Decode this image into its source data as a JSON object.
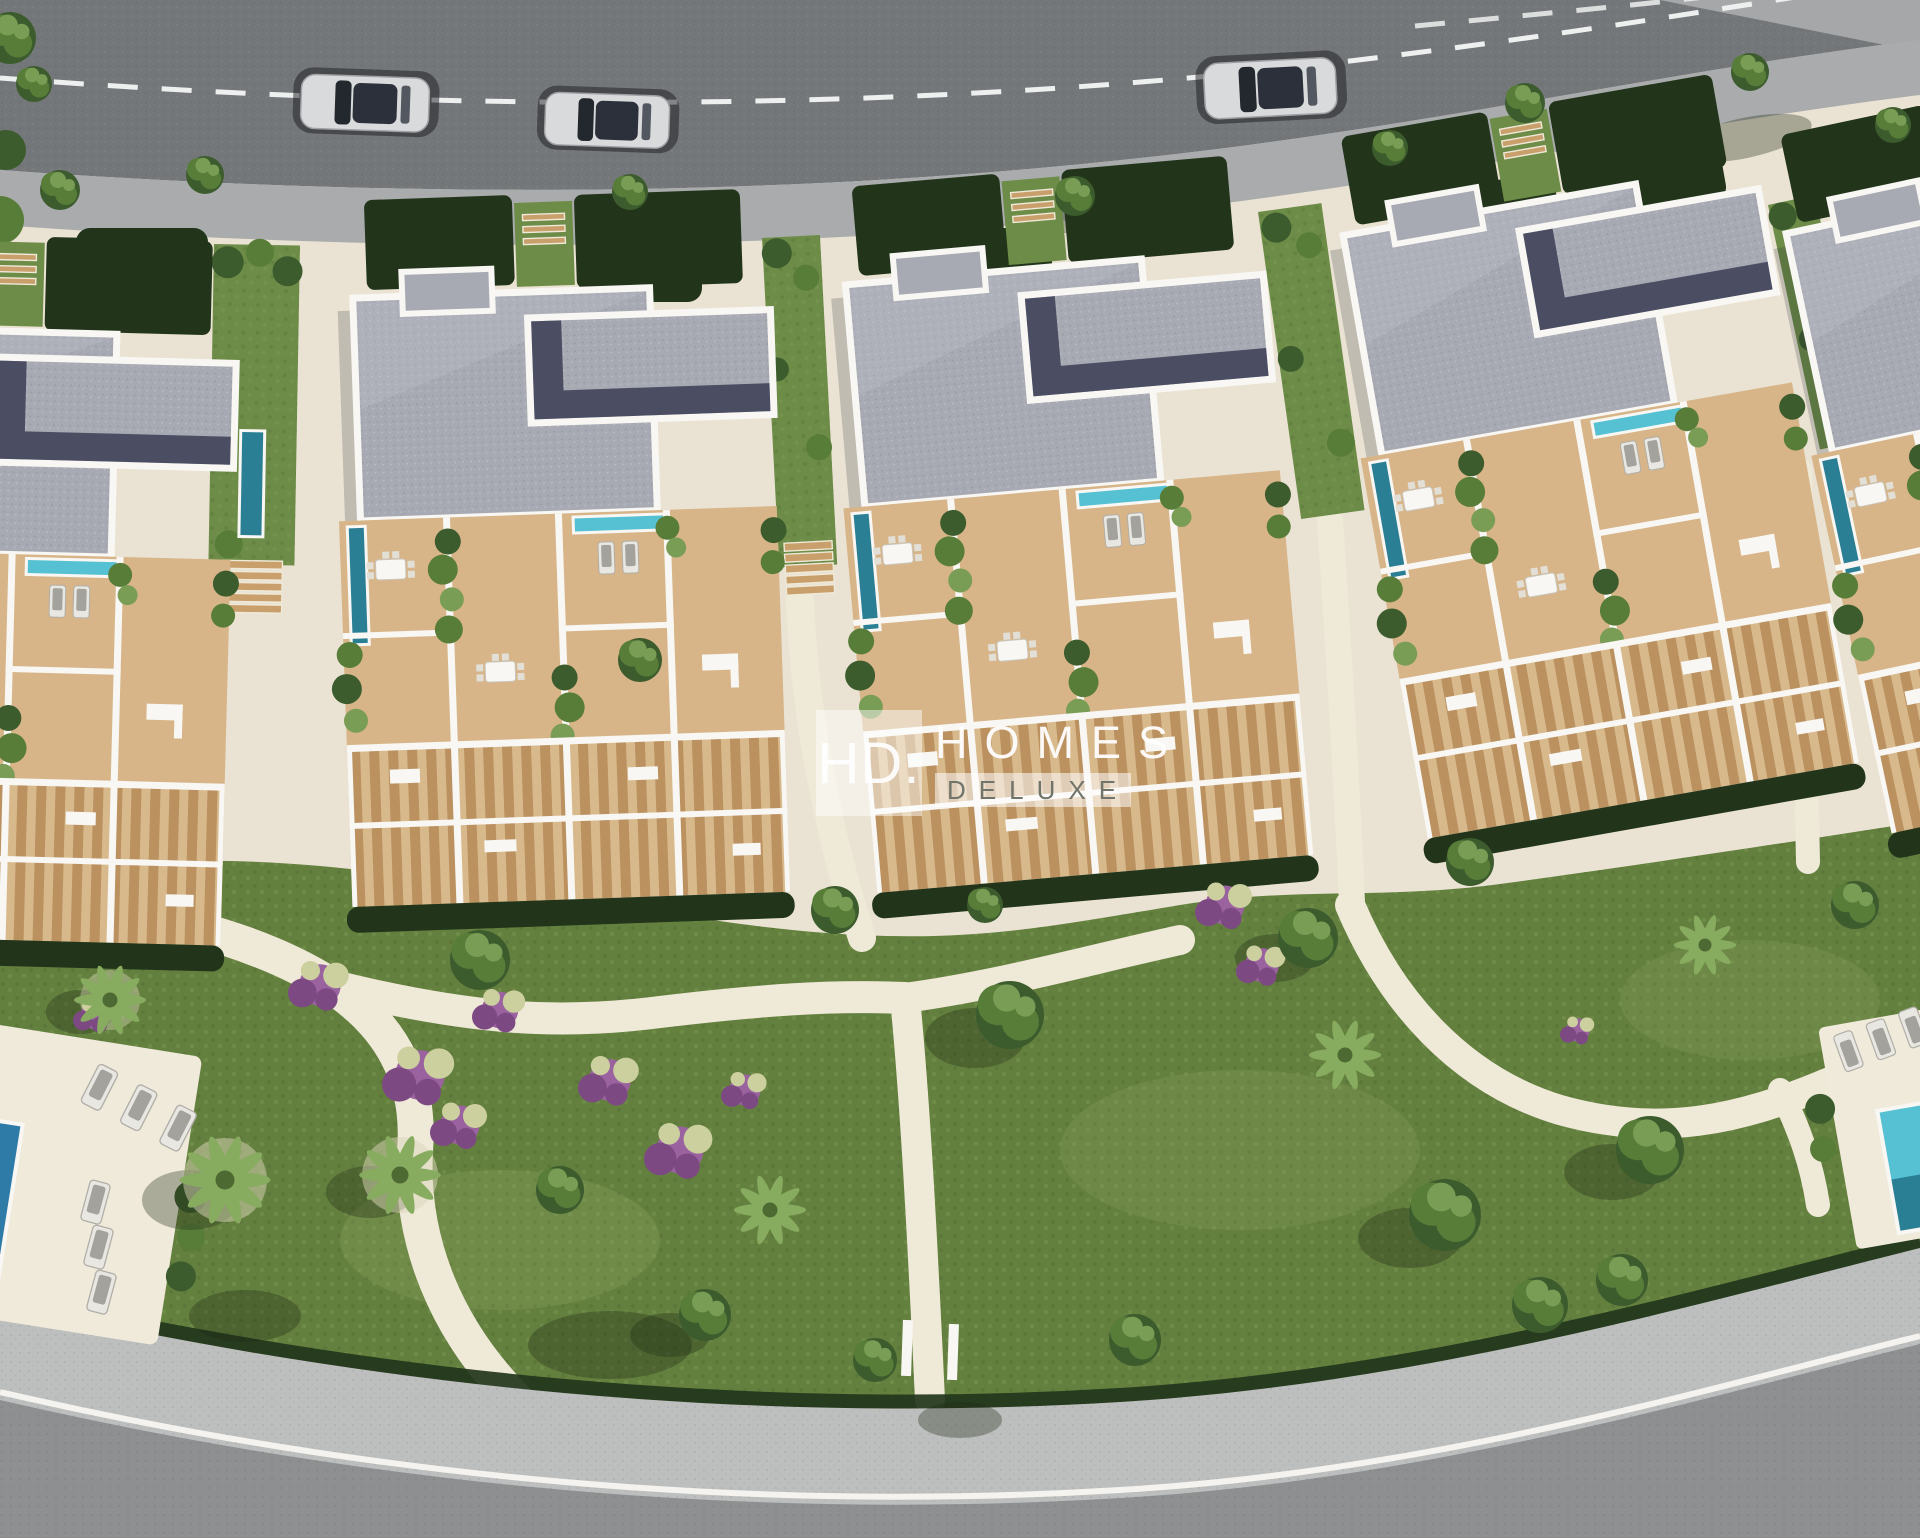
{
  "scene": {
    "setting": "aerial top-down 3D architectural rendering of a modern terraced-housing development beside a curved road",
    "watermark": {
      "abbr": "HD.",
      "name": "HOMES",
      "suffix": "DELUXE"
    },
    "objects": {
      "cars_on_road": 3,
      "car_colors": [
        "silver",
        "silver",
        "silver"
      ],
      "building_blocks_visible": 5,
      "communal_pools_visible": 2,
      "sun_loungers_left_pool": 6,
      "sun_loungers_right_pool": 4,
      "lane_marking": "dashed white center line",
      "curb_line": "solid white",
      "landscaping": [
        "lawns",
        "palm trees",
        "round trees",
        "dark hedges",
        "purple flower beds"
      ],
      "building_features": [
        "gray flat roofs",
        "white parapets",
        "roof terraces",
        "sand-coloured decks",
        "pergola slats",
        "teal plunge pools",
        "outdoor furniture"
      ]
    },
    "palette": {
      "road": "#747779",
      "road2": "#8d8f91",
      "roadline": "#eef0f0",
      "sidewalk": "#a9abac",
      "sidewalk2": "#bdbebe",
      "ground": "#eae3d3",
      "ground2": "#efe9d8",
      "deck": "#f0eadb",
      "terrace": "#d7b589",
      "pergola": "#bb9160",
      "pergola2": "#d8b98c",
      "wall": "#f8f7f3",
      "roof": "#a8aab3",
      "rooflight": "#c4c6ce",
      "roofdark": "#4b4d63",
      "hedge": "#22351b",
      "grass": "#6d8c48",
      "lawn": "#64803f",
      "lawnlight": "#93a865",
      "treedark": "#3c5c2e",
      "tree": "#587d39",
      "treelight": "#7a9d56",
      "palm": "#87ab5f",
      "flower": "#9a63a0",
      "flowerdeep": "#7c4983",
      "flowerpale": "#cccf9e",
      "pool": "#55c1d2",
      "pooldark": "#2a7f95",
      "poollane": "#2e7ba8",
      "carbody": "#d9dadb",
      "carglass": "#23272e",
      "watermark_text": "#ffffff",
      "watermark_deluxe": "#70746a"
    }
  }
}
